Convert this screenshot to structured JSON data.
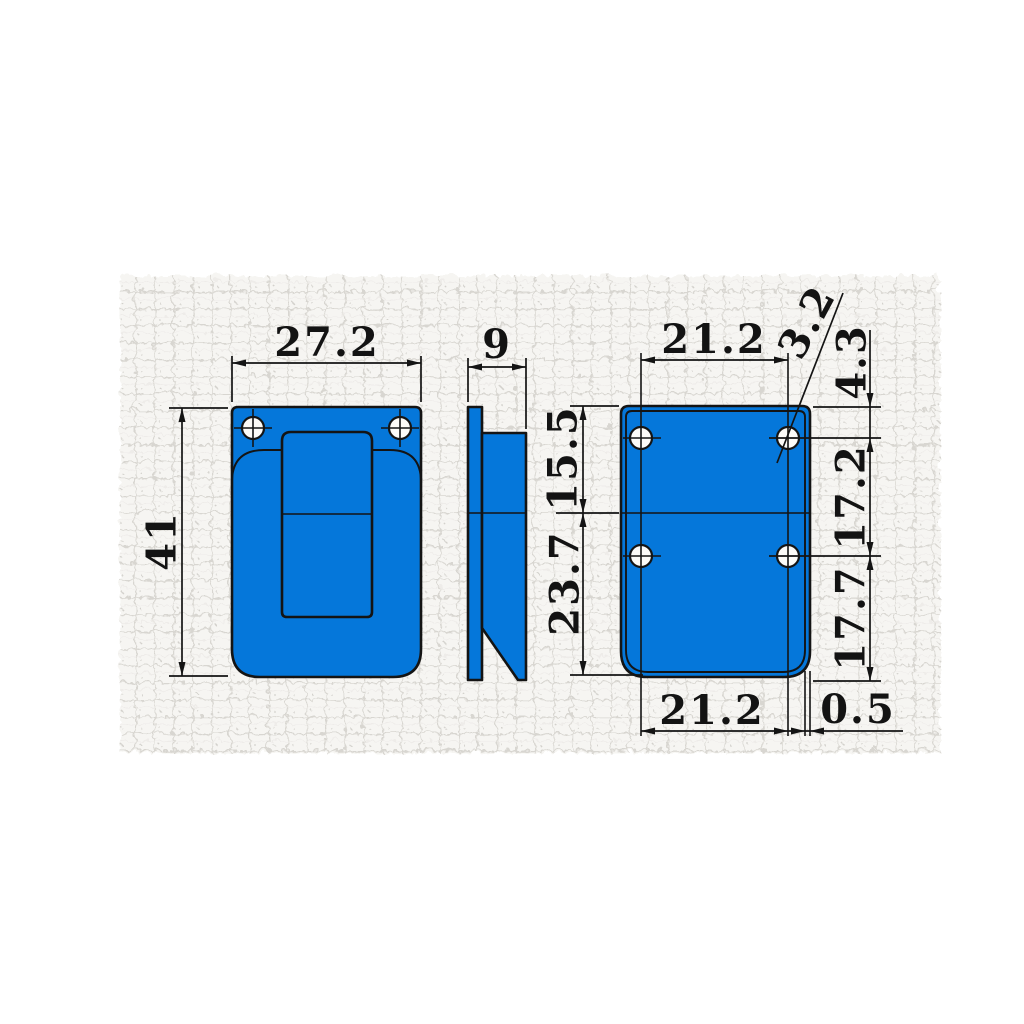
{
  "drawing": {
    "kind": "technical-drawing-three-views",
    "colors": {
      "part_fill": "#0577da",
      "line": "#141414",
      "texture_base": "#f6f5f2",
      "texture_line": "#d8d6d1",
      "page_background": "#ffffff"
    },
    "views": {
      "front": {
        "dims": {
          "width": "27.2",
          "height": "41"
        }
      },
      "side": {
        "dims": {
          "thickness": "9"
        }
      },
      "back": {
        "dims": {
          "hole_span_top": "21.2",
          "hole_diameter": "3.2",
          "hole_top_offset": "4.3",
          "upper_section": "15.5",
          "hole_pitch": "17.2",
          "lower_section": "23.7",
          "hole_bottom_offset": "17.7",
          "hole_span_bottom": "21.2",
          "edge_lip": "0.5"
        }
      }
    }
  }
}
